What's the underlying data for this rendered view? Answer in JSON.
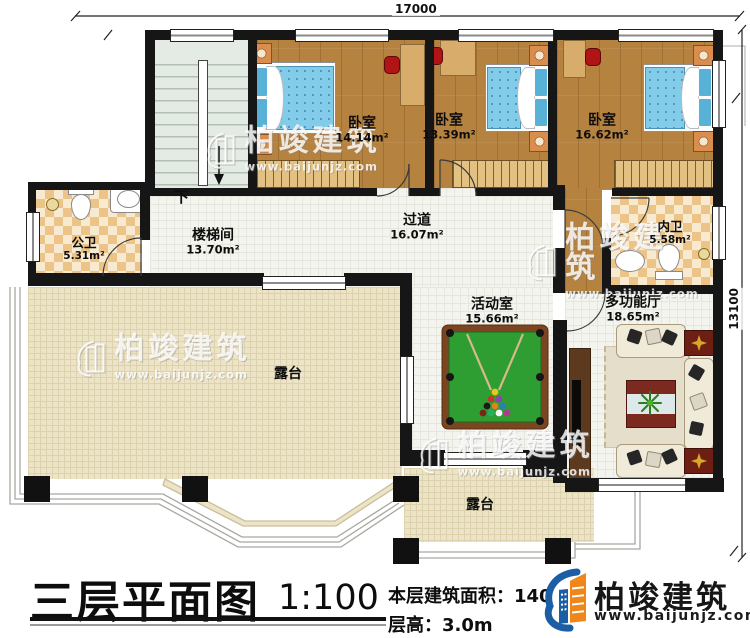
{
  "dimensions": {
    "top": "17000",
    "right": "13100"
  },
  "stairs": {
    "down": "下"
  },
  "rooms": {
    "bedroom1": {
      "name": "卧室",
      "area": "14.14m²"
    },
    "bedroom2": {
      "name": "卧室",
      "area": "13.39m²"
    },
    "bedroom3": {
      "name": "卧室",
      "area": "16.62m²"
    },
    "public_bath": {
      "name": "公卫",
      "area": "5.31m²"
    },
    "stairwell": {
      "name": "楼梯间",
      "area": "13.70m²"
    },
    "corridor": {
      "name": "过道",
      "area": "16.07m²"
    },
    "inner_bath": {
      "name": "内卫",
      "area": "5.58m²"
    },
    "activity": {
      "name": "活动室",
      "area": "15.66m²"
    },
    "hall": {
      "name": "多功能厅",
      "area": "18.65m²"
    },
    "terrace_main": {
      "name": "露台"
    },
    "terrace_small": {
      "name": "露台"
    }
  },
  "title_block": {
    "title": "三层平面图",
    "scale": "1:100",
    "floor_area_label": "本层建筑面积：140",
    "floor_height_label": "层高：3.0m"
  },
  "brand": {
    "name": "柏竣建筑",
    "website": "www.baijunjz.com"
  },
  "watermark": {
    "name": "柏竣建筑",
    "website": "www.baijunjz.com"
  },
  "colors": {
    "wall": "#161616",
    "wood_floor": "#b5823f",
    "tile_floor": "#f4f4ef",
    "terrace_floor": "#ede4c8",
    "bath_tile_a": "#ecc488",
    "bath_tile_b": "#f8ead0",
    "stair_floor": "#e4eae4",
    "bed_mattress": "#82cce9",
    "billiard_green": "#2f9e32",
    "billiard_rim": "#7a4520",
    "accent_red": "#b11414",
    "sofa_cream": "#f0ead9",
    "table_red": "#7c2a20",
    "logo_blue": "#1b5ea6",
    "logo_orange": "#f08619"
  }
}
